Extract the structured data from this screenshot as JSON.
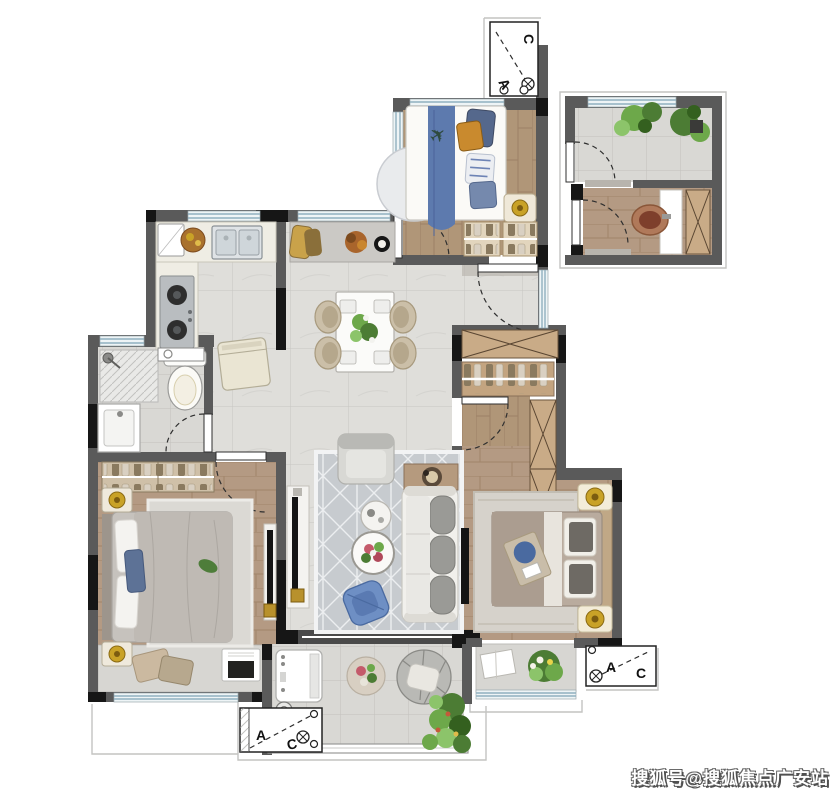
{
  "watermark": {
    "text": "搜狐号@搜狐焦点广安站"
  },
  "markers": {
    "a": "A",
    "c": "C"
  },
  "icons": {
    "toy_plane": "✈"
  },
  "colors": {
    "wall_gray": "#5a5a5a",
    "structure_black": "#161616",
    "tile_floor": "#dddcd8",
    "wood_floor": "#b59a82",
    "window_blue": "#8fb0bf",
    "rug_gray": "#c7cbcf",
    "accent_blue": "#6e8fc4",
    "kids_blanket_blue": "#5d7aae",
    "plant_green": "#4c7c34",
    "gold_accent": "#c9a227",
    "watermark_text": "#ffffff"
  }
}
